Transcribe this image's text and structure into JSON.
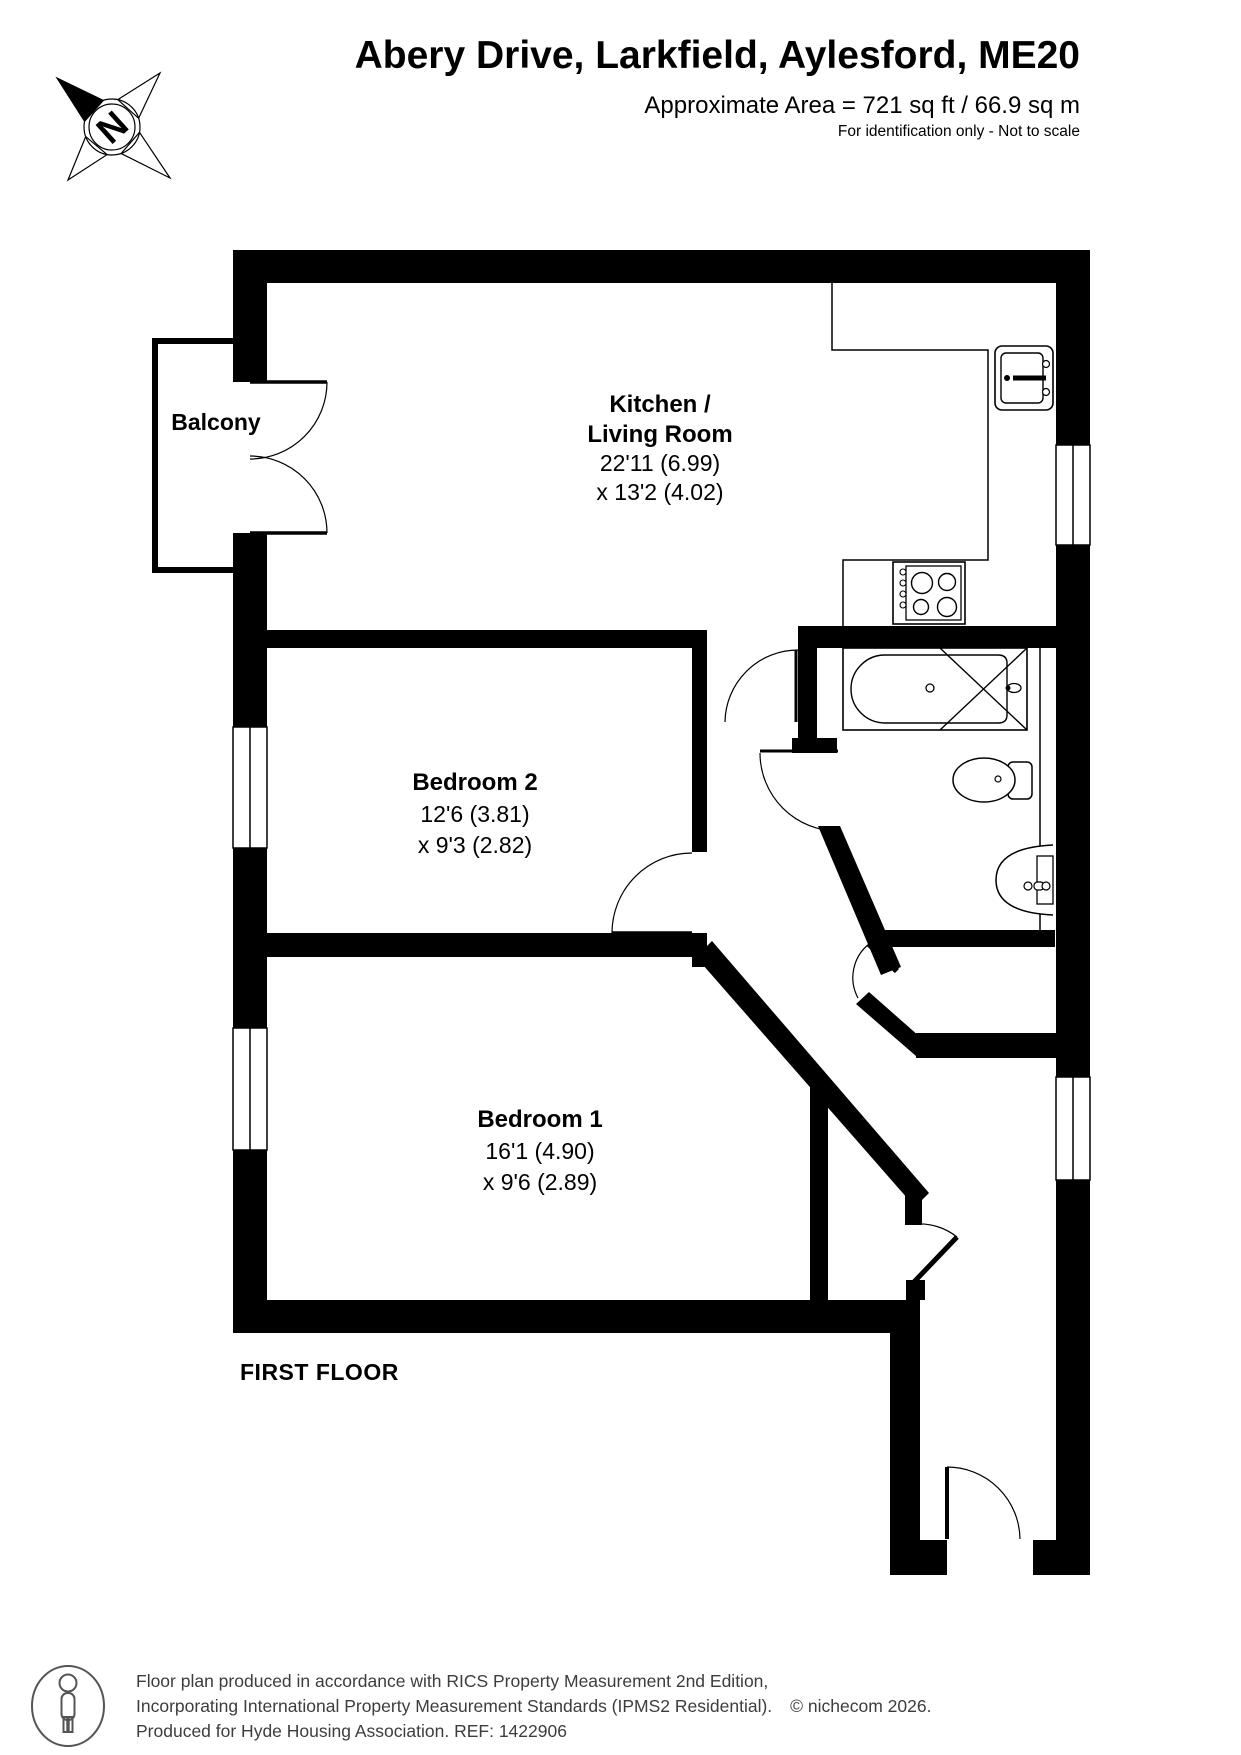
{
  "header": {
    "title": "Abery Drive, Larkfield, Aylesford, ME20",
    "area": "Approximate Area = 721 sq ft / 66.9 sq m",
    "note": "For identification only - Not to scale",
    "compass": "N"
  },
  "plan": {
    "floor_label": "FIRST FLOOR",
    "balcony": {
      "name": "Balcony"
    },
    "kitchen_living": {
      "name1": "Kitchen /",
      "name2": "Living Room",
      "dim1": "22'11 (6.99)",
      "dim2": "x 13'2 (4.02)"
    },
    "bedroom2": {
      "name": "Bedroom 2",
      "dim1": "12'6 (3.81)",
      "dim2": "x 9'3 (2.82)"
    },
    "bedroom1": {
      "name": "Bedroom 1",
      "dim1": "16'1 (4.90)",
      "dim2": "x 9'6 (2.89)"
    }
  },
  "footer": {
    "line1": "Floor plan produced in accordance with RICS Property Measurement 2nd Edition,",
    "line2": "Incorporating International Property Measurement Standards (IPMS2 Residential).",
    "copyright": "© nichecom 2026.",
    "line3": "Produced for Hyde Housing Association.  REF: 1422906"
  },
  "colors": {
    "wall": "#000000",
    "footer_text": "#3d3d3d"
  }
}
